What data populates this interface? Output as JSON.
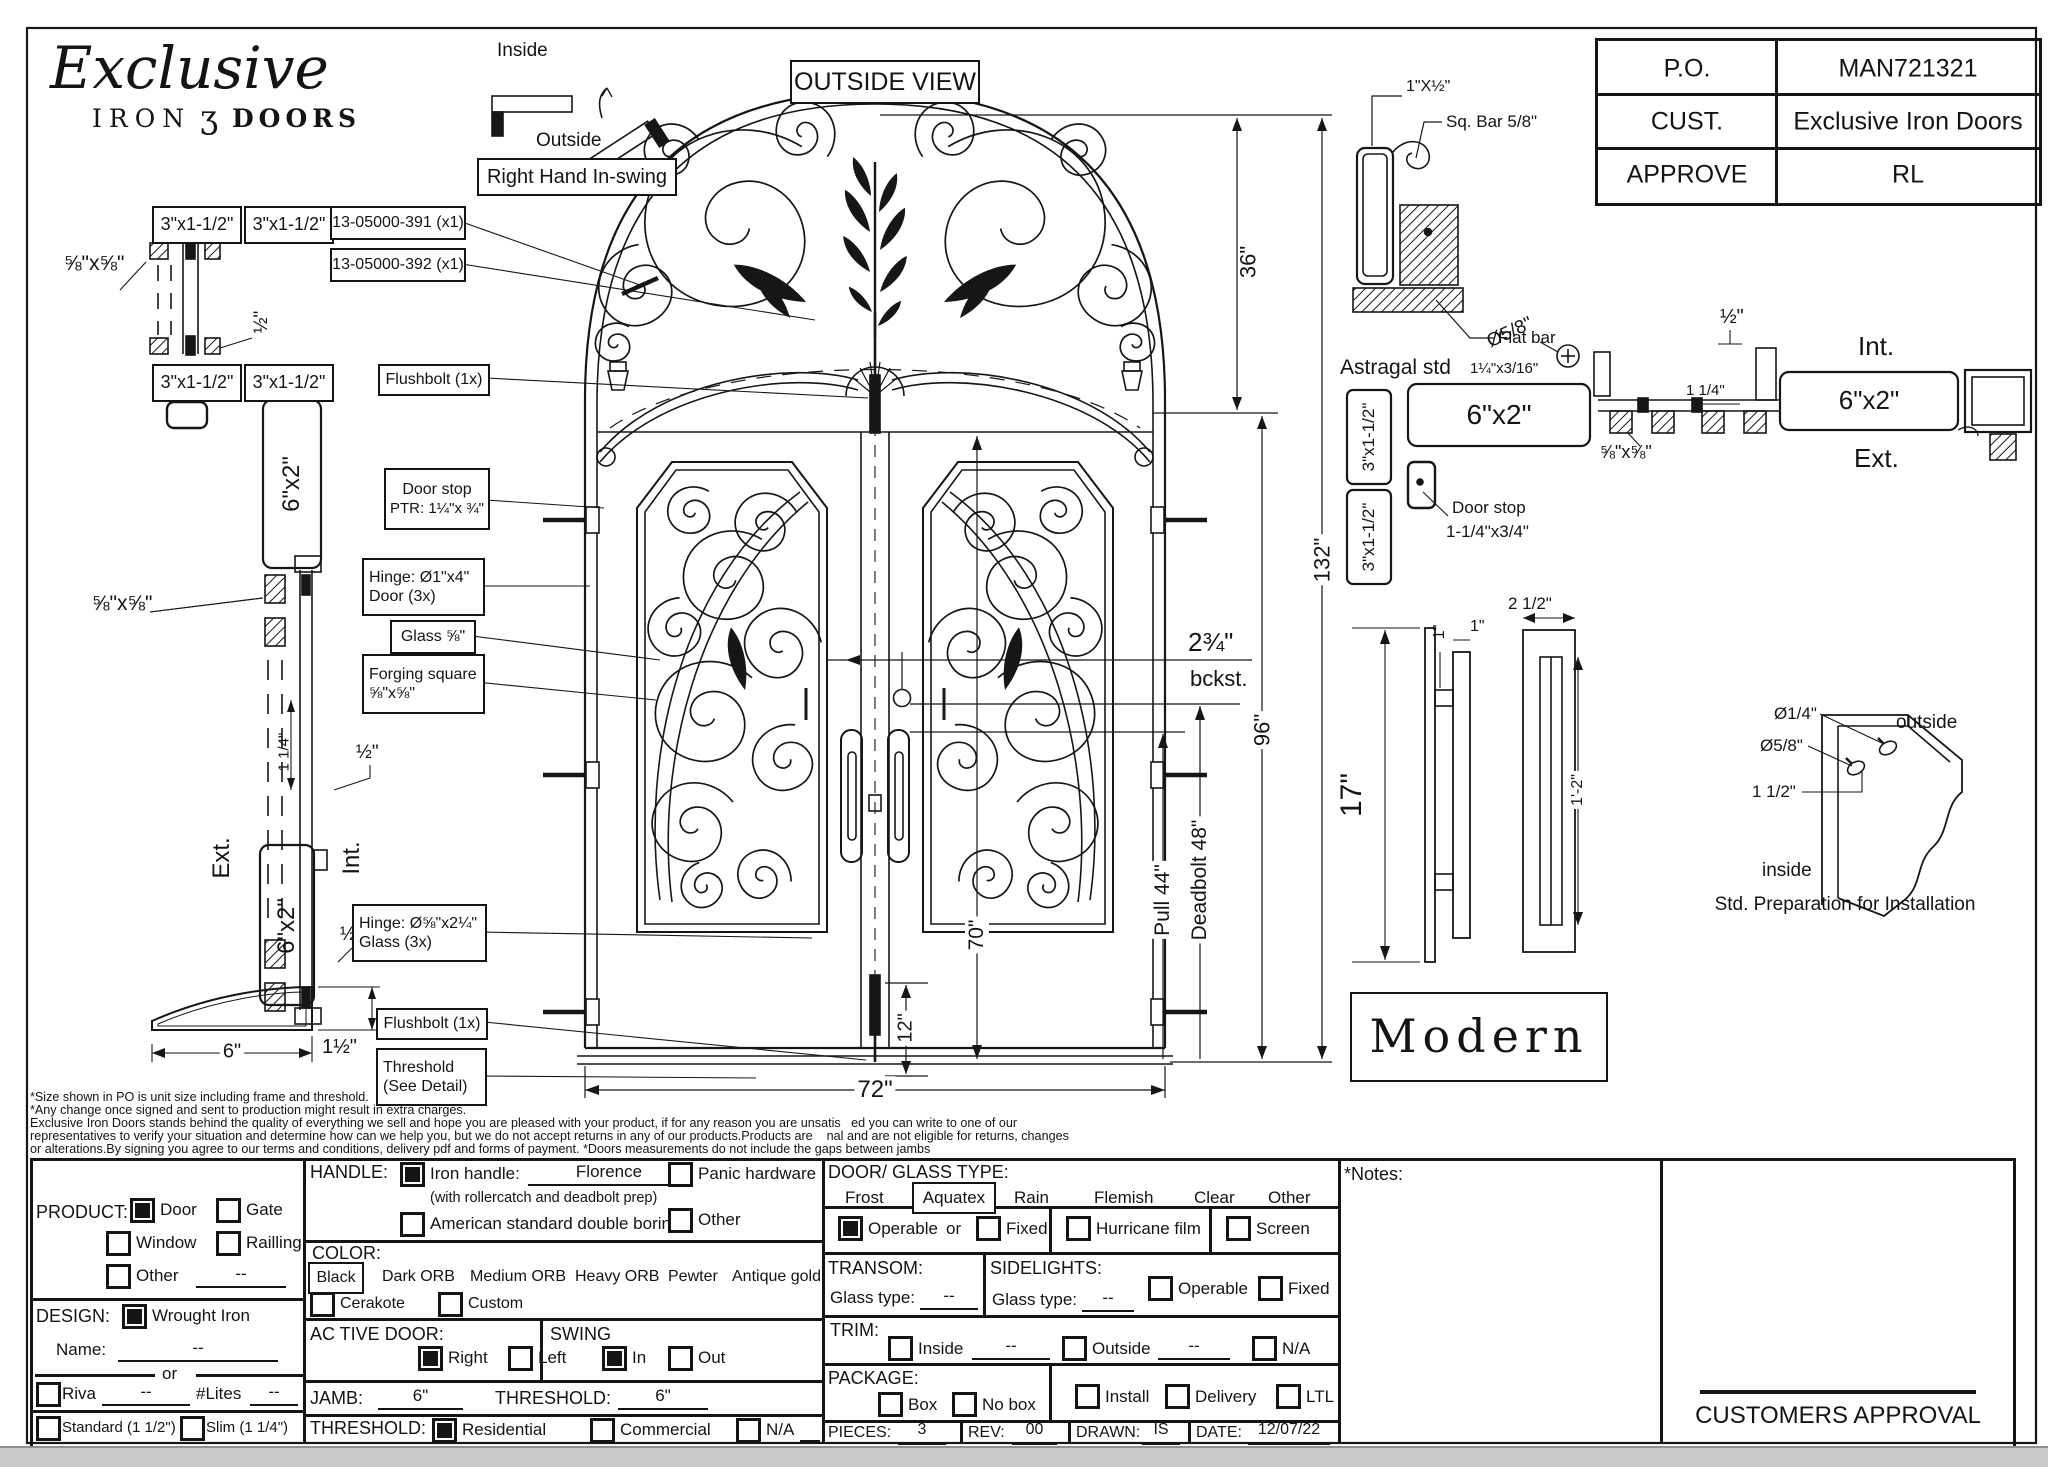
{
  "sheet": {
    "logo": {
      "script": "Exclusive",
      "iron": "IRON",
      "ornament": "ʒ",
      "doors": "DOORS"
    },
    "swing_diagram": {
      "inside": "Inside",
      "outside": "Outside",
      "label": "Right Hand In-swing"
    },
    "view_label": "OUTSIDE VIEW",
    "po_table": {
      "rows": [
        {
          "label": "P.O.",
          "value": "MAN721321"
        },
        {
          "label": "CUST.",
          "value": "Exclusive Iron Doors"
        },
        {
          "label": "APPROVE",
          "value": "RL"
        }
      ]
    },
    "astragal": {
      "dim_top": "1\"X½\"",
      "sq_bar": "Sq. Bar 5/8\"",
      "flat_bar": "Flat bar",
      "title": "Astragal std",
      "size": "1¼\"x3/16\""
    },
    "left_detail": {
      "box1": "3\"x1-1/2\"",
      "box2": "3\"x1-1/2\"",
      "box3": "3\"x1-1/2\"",
      "box4": "3\"x1-1/2\"",
      "d5858_top": "⅝\"x⅝\"",
      "half_top": "½\"",
      "tube_top": "6\"x2\"",
      "d5858_mid": "⅝\"x⅝\"",
      "d114": "1 1/4\"",
      "half_mid": "½\"",
      "ext": "Ext.",
      "int": "Int.",
      "tube_bottom": "6\"x2\"",
      "half_bottom": "½\"",
      "d6": "6\"",
      "d152": "1½\""
    },
    "callouts": {
      "c391": "13-05000-391 (x1)",
      "c392": "13-05000-392 (x1)",
      "flushbolt_top": "Flushbolt (1x)",
      "door_stop_1": "Door stop",
      "door_stop_2": "PTR: 1¼\"x ¾\"",
      "hinge_door_1": "Hinge: Ø1\"x4\"",
      "hinge_door_2": "Door (3x)",
      "glass": "Glass ⅝\"",
      "forging_1": "Forging square",
      "forging_2": "⅝\"x⅝\"",
      "hinge_glass_1": "Hinge: Ø⅝\"x2¼\"",
      "hinge_glass_2": "Glass (3x)",
      "flushbolt_bottom": "Flushbolt (1x)",
      "threshold_1": "Threshold",
      "threshold_2": "(See Detail)"
    },
    "dims": {
      "d36": "36\"",
      "d132": "132\"",
      "d96": "96\"",
      "bckst_num": "2¾\"",
      "bckst": "bckst.",
      "deadbolt": "Deadbolt 48\"",
      "pull": "Pull 44\"",
      "d70": "70\"",
      "d12": "12\"",
      "d72": "72\"",
      "d17": "17\"",
      "d1a": "1\"",
      "d1b": "1\"",
      "d212": "2 1/2\"",
      "d1_2": "1'-2\""
    },
    "right_detail": {
      "box1": "3\"x1-1/2\"",
      "box2": "3\"x1-1/2\"",
      "tube": "6\"x2\"",
      "screw": "Ø5/8\"",
      "door_stop_1": "Door stop",
      "door_stop_2": "1-1/4\"x3/4\"",
      "half": "½\"",
      "d114": "1 1/4\"",
      "int": "Int.",
      "tube2": "6\"x2\"",
      "ext": "Ext.",
      "d5858": "⅝\"x⅝\""
    },
    "modern": "Modern",
    "install": {
      "d14": "Ø1/4\"",
      "outside": "outside",
      "d58": "Ø5/8\"",
      "d112": "1 1/2\"",
      "inside": "inside",
      "caption": "Std. Preparation for Installation"
    },
    "disclaimer": [
      "*Size shown in PO is unit size including frame and threshold.",
      "*Any change once signed and sent to production might result in extra charges.",
      "Exclusive Iron Doors stands behind the quality of everything we sell and hope you are pleased with your product, if for any reason you are unsatis   ed you can write to one of our",
      "representatives to verify your situation and determine how can we help you, but we do not accept returns in any of our products.Products are    nal and are not eligible for returns, changes",
      "or alterations.By signing you agree to our terms and conditions, delivery pdf and forms of payment. *Doors measurements do not include the gaps between jambs"
    ],
    "form": {
      "product": {
        "label": "PRODUCT:",
        "door": "Door",
        "gate": "Gate",
        "window": "Window",
        "railing": "Railling",
        "other": "Other",
        "other_value": "--"
      },
      "design": {
        "label": "DESIGN:",
        "wrought": "Wrought Iron",
        "name": "Name:",
        "name_value": "--",
        "or": "or",
        "riva": "Riva",
        "riva_value": "--",
        "lites": "#Lites",
        "lites_value": "--",
        "standard": "Standard (1 1/2\")",
        "slim": "Slim (1 1/4\")"
      },
      "handle": {
        "label": "HANDLE:",
        "iron": "Iron handle:",
        "iron_value": "Florence",
        "iron_note": "(with rollercatch and deadbolt prep)",
        "american": "American standard double boring",
        "panic": "Panic hardware",
        "other": "Other"
      },
      "color": {
        "label": "COLOR:",
        "options": [
          "Black",
          "Dark ORB",
          "Medium ORB",
          "Heavy ORB",
          "Pewter",
          "Antique gold"
        ],
        "cerakote": "Cerakote",
        "custom": "Custom"
      },
      "active": {
        "label": "AC TIVE DOOR:",
        "right": "Right",
        "left": "Left"
      },
      "swing": {
        "label": "SWING",
        "in_": "In",
        "out": "Out"
      },
      "jamb": {
        "label": "JAMB:",
        "value": "6\"",
        "th_label": "THRESHOLD:",
        "th_value": "6\""
      },
      "threshold": {
        "label": "THRESHOLD:",
        "residential": "Residential",
        "commercial": "Commercial",
        "na": "N/A"
      },
      "glass_type": {
        "label": "DOOR/ GLASS TYPE:",
        "frost": "Frost",
        "aquatex": "Aquatex",
        "rain": "Rain",
        "flemish": "Flemish",
        "clear": "Clear",
        "other": "Other",
        "operable": "Operable",
        "or": "or",
        "fixed": "Fixed",
        "hurricane": "Hurricane film",
        "screen": "Screen"
      },
      "transom": {
        "label": "TRANSOM:",
        "glass": "Glass type:",
        "value": "--"
      },
      "sidelights": {
        "label": "SIDELIGHTS:",
        "glass": "Glass type:",
        "value": "--",
        "operable": "Operable",
        "fixed": "Fixed"
      },
      "trim": {
        "label": "TRIM:",
        "inside": "Inside",
        "inside_value": "--",
        "outside": "Outside",
        "outside_value": "--",
        "na": "N/A"
      },
      "package": {
        "label": "PACKAGE:",
        "box": "Box",
        "nobox": "No box",
        "install": "Install",
        "delivery": "Delivery",
        "ltl": "LTL"
      },
      "meta": {
        "pieces_label": "PIECES:",
        "pieces": "3",
        "rev_label": "REV:",
        "rev": "00",
        "drawn_label": "DRAWN:",
        "drawn": "IS",
        "date_label": "DATE:",
        "date": "12/07/22"
      }
    },
    "notes": "*Notes:",
    "approval": "CUSTOMERS APPROVAL"
  }
}
